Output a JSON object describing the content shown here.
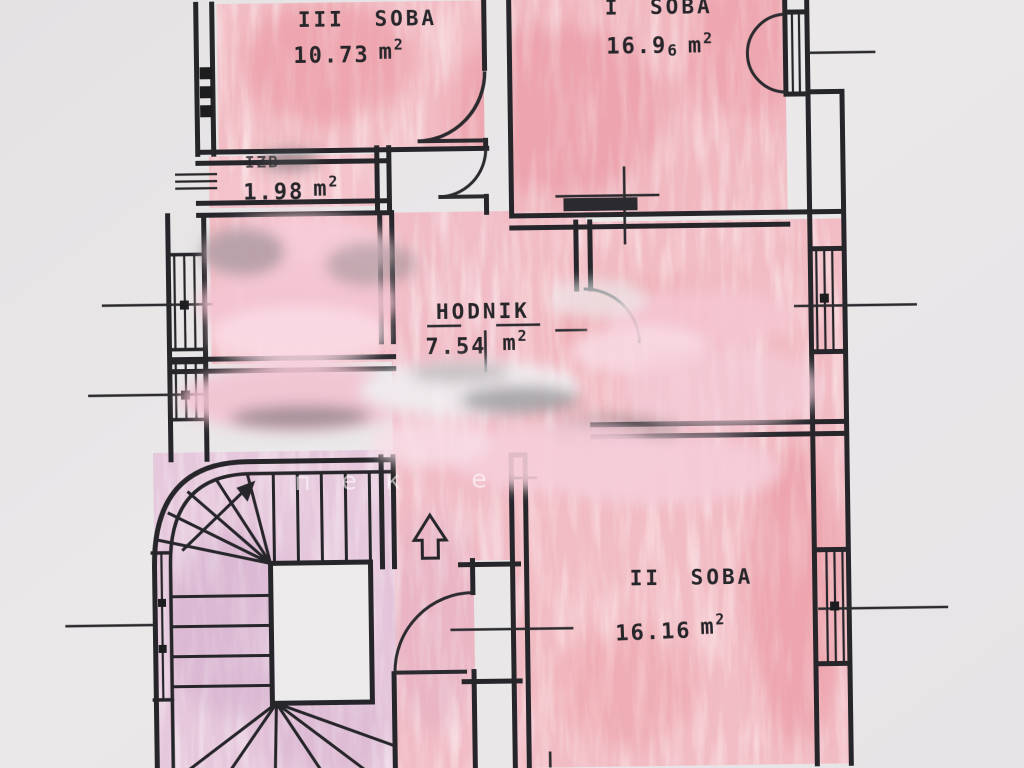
{
  "document": {
    "kind": "apartment floor plan (photographed paper drawing)",
    "language_hint": "sr/hr"
  },
  "palette": {
    "paper": "#e9e7e8",
    "wall": "#26262a",
    "room_pink": "#f2bcc4",
    "room_pink_deep": "#e4717f",
    "stairs_tint": "#e6c8dc",
    "smear_pink": "#f6cdd9",
    "text": "#26262a",
    "watermark": "#ffffff"
  },
  "unit": {
    "m": "m",
    "sup": "2"
  },
  "rooms": [
    {
      "id": "soba-3",
      "name": "III SOBA",
      "area": "10.73",
      "area_small": ""
    },
    {
      "id": "soba-1",
      "name": "I SOBA",
      "area": "16.9",
      "area_small": "6"
    },
    {
      "id": "izba",
      "name": "IZB",
      "area": "1.98",
      "area_small": ""
    },
    {
      "id": "hodnik",
      "name": "HODNIK",
      "area": "7.54",
      "area_small": ""
    },
    {
      "id": "soba-2",
      "name": "II SOBA",
      "area": "16.16",
      "area_small": ""
    }
  ],
  "watermark": {
    "letters": [
      "п",
      "е",
      "к",
      "е"
    ]
  }
}
